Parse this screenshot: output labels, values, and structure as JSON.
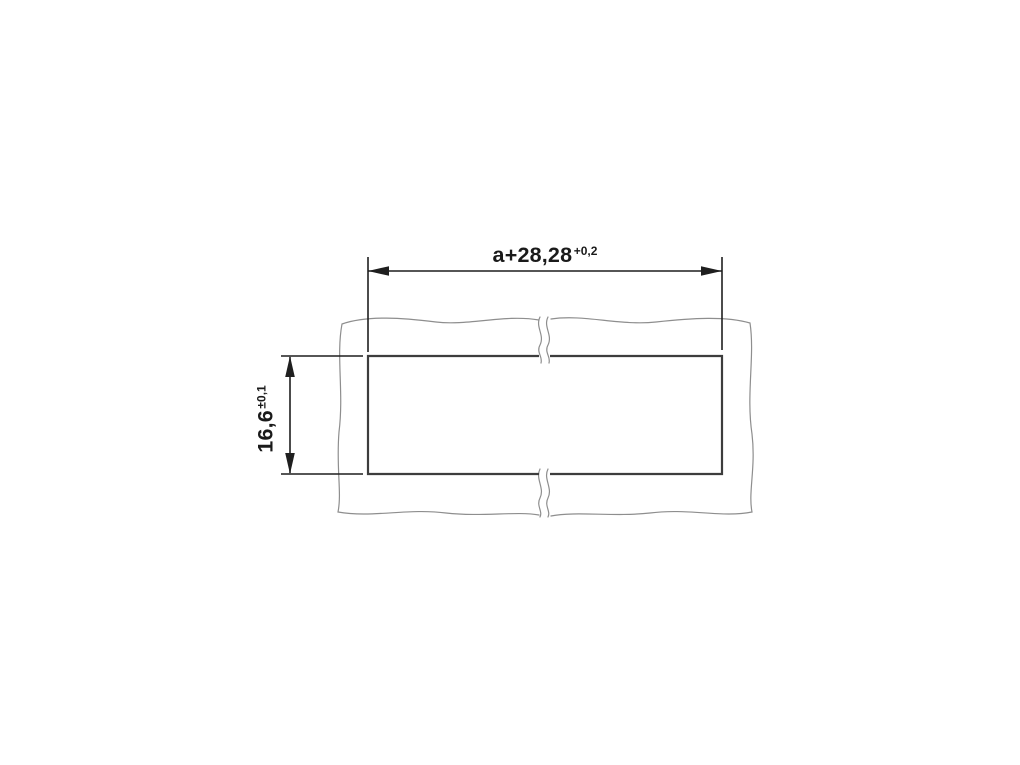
{
  "diagram": {
    "kind": "panel-cutout-dimension-drawing",
    "dimensions": {
      "width": {
        "value": "a+28,28",
        "tolerance": "+0,2"
      },
      "height": {
        "value": "16,6",
        "tolerance": "±0,1"
      }
    },
    "colors": {
      "background": "#ffffff",
      "dimension_lines": "#1f1f1f",
      "cutout_outline": "#3d3d3d",
      "panel_outline": "#8e8e8e",
      "text": "#1a1a1a"
    }
  }
}
